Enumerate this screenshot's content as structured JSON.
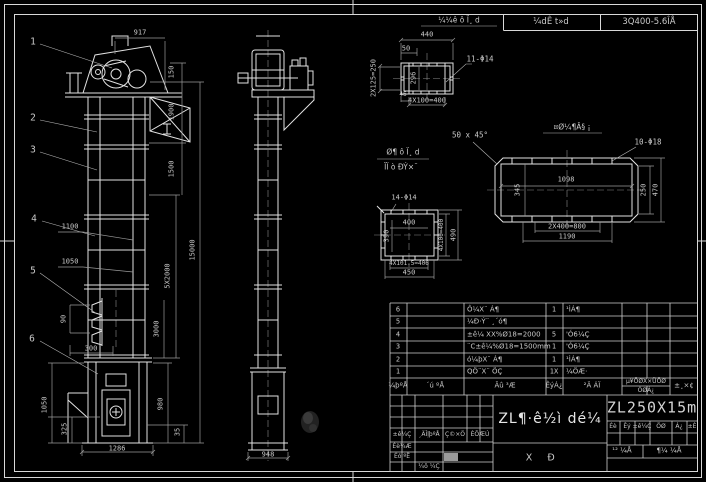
{
  "header": {
    "cell1": "¼dÊ t»d",
    "cell2": "3Q400-5.6ÎÅ"
  },
  "part_numbers": [
    "1",
    "2",
    "3",
    "4",
    "5",
    "6"
  ],
  "front": {
    "d917": "917",
    "d150": "150",
    "d1900": "1900",
    "d1500": "1500",
    "d15000": "15000",
    "d5x2000": "5X2000",
    "d3000": "3000",
    "d1100": "1100",
    "d1050a": "1050",
    "d90": "90",
    "d300": "300",
    "d1050b": "1050",
    "d325": "325",
    "d980": "980",
    "d35": "35",
    "d1286": "1286"
  },
  "side": {
    "d948": "948"
  },
  "detail_a": {
    "label": "¼¼ê ô Ï¸ d",
    "d440": "440",
    "d50": "50",
    "holes": "11-Φ14",
    "left": "2X125=250",
    "inner": "296",
    "d46": "46",
    "bottom": "4X100=400"
  },
  "detail_b": {
    "label": "¤Ø¼¶Â§ ¡",
    "chamfer": "50 x 45°",
    "holes": "10-Φ18",
    "inner_w": "1098",
    "inner_h": "345",
    "right1": "250",
    "right2": "470",
    "bottom1": "2X400=800",
    "bottom2": "1190"
  },
  "detail_c": {
    "label1": "Ø¶ ô Ï¸ d",
    "label2": "ÏÏ ò ÐÝ×¨",
    "holes": "14-Φ14",
    "inner_w": "400",
    "inner_h": "390",
    "right1": "4X100=400",
    "right2": "490",
    "bottom1": "4X101.5=406",
    "bottom2": "450"
  },
  "bom": {
    "headers": {
      "no": "¼þºÅ",
      "code": "´ú ºÅ",
      "name": "Ãû ³Æ",
      "qty": "ÊýÁ¿",
      "material": "²Ä ÁÏ",
      "weight_top": "µ¥ÖØX×ÜÖØ",
      "weight_bottom": "ÖØÁ¿",
      "remark": "±¸×¢"
    },
    "rows": [
      {
        "no": "6",
        "code": "",
        "name": "Ô¼X¨ Á¶",
        "qty": "1",
        "material": "¹ÌÁ¶"
      },
      {
        "no": "5",
        "code": "",
        "name": "¼Ð·Ý¨ ¸´ó¶",
        "qty": "",
        "material": ""
      },
      {
        "no": "4",
        "code": "",
        "name": "±ê¼ XX%Ø18=2000",
        "qty": "5",
        "material": "'Ó6¼Ç"
      },
      {
        "no": "3",
        "code": "",
        "name": "¨C±ê¼%Ø18=1500mm",
        "qty": "1",
        "material": "'Ó6¼Ç"
      },
      {
        "no": "2",
        "code": "",
        "name": "ó¼þX¨ Á¶",
        "qty": "1",
        "material": "¹ÌÁ¶"
      },
      {
        "no": "1",
        "code": "",
        "name": "QÖ¨X¨ ÖÇ",
        "qty": "1X",
        "material": "¼ÖÆ·"
      }
    ]
  },
  "title_block": {
    "main_title": "ZL¶·ê½ì dé¼",
    "drawing_no": "ZL250X15m",
    "rev_cols": [
      "±ê¼Ç",
      "¸ÄÎļþºÅ",
      "Ç©×Ö",
      "ÈÕÆÚ"
    ],
    "sign_rows": [
      "Éè¼Æ",
      "Éó ºË",
      "¼ô ¼Ç"
    ],
    "info_cells": [
      "Éè",
      "Êý",
      "±ê¼Ç",
      "ÖØ",
      "Á¿",
      "±È"
    ],
    "pages_left": "¹² ¼Å",
    "pages_right": "¶¼ ¼Å",
    "stage1": "Χ",
    "stage2": "Ð"
  },
  "colors": {
    "background": "#000000",
    "line": "#e2e2e2",
    "dim": "#9a9a9a",
    "text": "#c9c9c9"
  }
}
